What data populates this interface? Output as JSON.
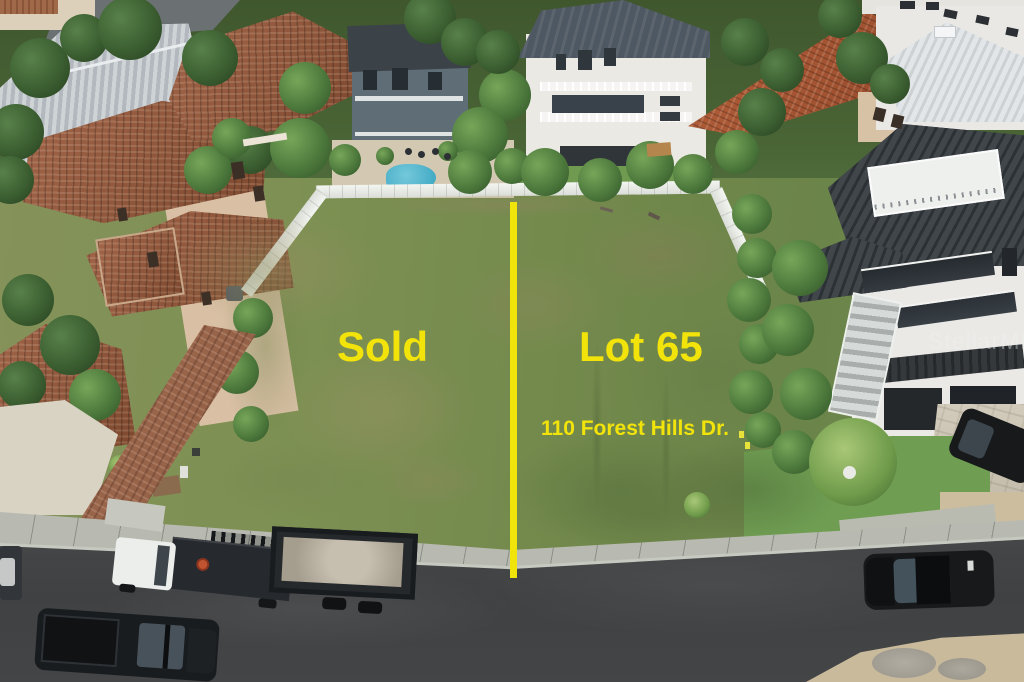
{
  "overlay": {
    "sold_label": "Sold",
    "lot_label": "Lot 65",
    "address_label": "110 Forest Hills Dr.",
    "label_color": "#F2E40B",
    "divider_color": "#F0E40A"
  },
  "watermark": {
    "text": "StellarMLS"
  }
}
